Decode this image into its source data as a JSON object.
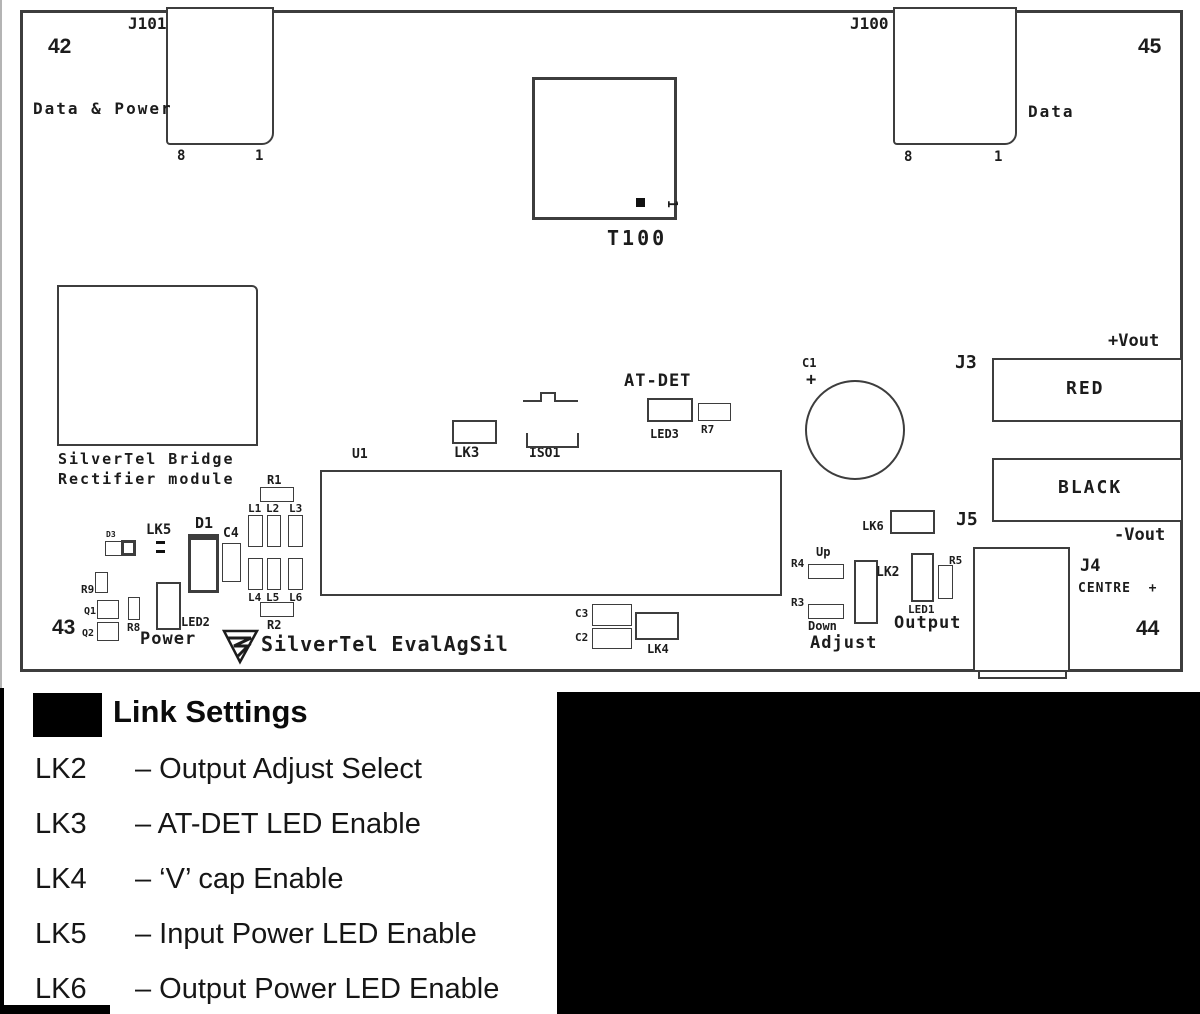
{
  "figure": {
    "name": "SilverTel EvalAgSil evaluation board layout",
    "board_title": "SilverTel EvalAgSil"
  },
  "colors": {
    "background": "#ffffff",
    "board_outline": "#222222",
    "component_outline": "#3d3d3d",
    "text": "#1c1c1c",
    "black_fill": "#000000"
  },
  "legend": {
    "title": "Link Settings",
    "rows": [
      {
        "code": "LK2",
        "desc": "– Output Adjust Select"
      },
      {
        "code": "LK3",
        "desc": "– AT-DET LED Enable"
      },
      {
        "code": "LK4",
        "desc": "– ‘V’ cap Enable"
      },
      {
        "code": "LK5",
        "desc": "– Input Power LED Enable"
      },
      {
        "code": "LK6",
        "desc": "– Output Power LED Enable"
      }
    ]
  },
  "board": {
    "rects": [
      {
        "n": "board-outline",
        "x": 20,
        "y": 10,
        "w": 1163,
        "h": 662,
        "bw": 3
      },
      {
        "n": "connector-j101",
        "x": 166,
        "y": 7,
        "w": 108,
        "h": 138,
        "bw": 2.5,
        "r": "0 0 12px 4px"
      },
      {
        "n": "connector-j100",
        "x": 893,
        "y": 7,
        "w": 124,
        "h": 138,
        "bw": 2.5,
        "r": "0 0 12px 4px"
      },
      {
        "n": "transformer-t100",
        "x": 532,
        "y": 77,
        "w": 145,
        "h": 143,
        "bw": 3
      },
      {
        "n": "t100-pin1-dot",
        "x": 636,
        "y": 198,
        "w": 9,
        "h": 9,
        "fill": true
      },
      {
        "n": "bridge-rectifier-module",
        "x": 57,
        "y": 285,
        "w": 201,
        "h": 161,
        "bw": 2,
        "r": "0 6px 0 0"
      },
      {
        "n": "ic-u1-box",
        "x": 320,
        "y": 470,
        "w": 462,
        "h": 126,
        "bw": 2
      },
      {
        "n": "link-lk3-box",
        "x": 452,
        "y": 420,
        "w": 45,
        "h": 24,
        "bw": 2
      },
      {
        "n": "led3-box",
        "x": 647,
        "y": 398,
        "w": 46,
        "h": 24,
        "bw": 2
      },
      {
        "n": "r7-box",
        "x": 698,
        "y": 403,
        "w": 33,
        "h": 18,
        "bw": 1.5
      },
      {
        "n": "terminal-red-box",
        "x": 992,
        "y": 358,
        "w": 191,
        "h": 64,
        "bw": 2.5
      },
      {
        "n": "terminal-black-box",
        "x": 992,
        "y": 458,
        "w": 191,
        "h": 64,
        "bw": 2.5
      },
      {
        "n": "link-lk6-box",
        "x": 890,
        "y": 510,
        "w": 45,
        "h": 24,
        "bw": 2
      },
      {
        "n": "d3-box-a",
        "x": 105,
        "y": 541,
        "w": 18,
        "h": 15,
        "bw": 1.5
      },
      {
        "n": "d3-box-b",
        "x": 121,
        "y": 540,
        "w": 15,
        "h": 16,
        "bw": 3
      },
      {
        "n": "lk5-dash-1",
        "x": 156,
        "y": 541,
        "w": 9,
        "h": 3,
        "fill": true
      },
      {
        "n": "lk5-dash-2",
        "x": 156,
        "y": 550,
        "w": 9,
        "h": 3,
        "fill": true
      },
      {
        "n": "diode-d1-box",
        "x": 188,
        "y": 534,
        "w": 31,
        "h": 59,
        "bw": 3,
        "bt": 6
      },
      {
        "n": "cap-c4-box",
        "x": 222,
        "y": 543,
        "w": 19,
        "h": 39,
        "bw": 1.5
      },
      {
        "n": "r1-box",
        "x": 260,
        "y": 487,
        "w": 34,
        "h": 15,
        "bw": 1.5
      },
      {
        "n": "l1-box",
        "x": 248,
        "y": 515,
        "w": 15,
        "h": 32,
        "bw": 1.5
      },
      {
        "n": "l2-box",
        "x": 267,
        "y": 515,
        "w": 14,
        "h": 32,
        "bw": 1.5
      },
      {
        "n": "l3-box",
        "x": 288,
        "y": 515,
        "w": 15,
        "h": 32,
        "bw": 1.5
      },
      {
        "n": "l4-box",
        "x": 248,
        "y": 558,
        "w": 15,
        "h": 32,
        "bw": 1.5
      },
      {
        "n": "l5-box",
        "x": 267,
        "y": 558,
        "w": 14,
        "h": 32,
        "bw": 1.5
      },
      {
        "n": "l6-box",
        "x": 288,
        "y": 558,
        "w": 15,
        "h": 32,
        "bw": 1.5
      },
      {
        "n": "r2-box",
        "x": 260,
        "y": 602,
        "w": 34,
        "h": 15,
        "bw": 1.5
      },
      {
        "n": "r9-box",
        "x": 95,
        "y": 572,
        "w": 13,
        "h": 21,
        "bw": 1.5
      },
      {
        "n": "q1-box",
        "x": 97,
        "y": 600,
        "w": 22,
        "h": 19,
        "bw": 1.5
      },
      {
        "n": "q2-box",
        "x": 97,
        "y": 622,
        "w": 22,
        "h": 19,
        "bw": 1.5
      },
      {
        "n": "r8-box",
        "x": 128,
        "y": 597,
        "w": 12,
        "h": 23,
        "bw": 1.5
      },
      {
        "n": "led2-box",
        "x": 156,
        "y": 582,
        "w": 25,
        "h": 48,
        "bw": 2
      },
      {
        "n": "cap-c3-box",
        "x": 592,
        "y": 604,
        "w": 40,
        "h": 22,
        "bw": 1.5
      },
      {
        "n": "cap-c2-box",
        "x": 592,
        "y": 628,
        "w": 40,
        "h": 21,
        "bw": 1.5
      },
      {
        "n": "link-lk4-box",
        "x": 635,
        "y": 612,
        "w": 44,
        "h": 28,
        "bw": 2
      },
      {
        "n": "r4-box",
        "x": 808,
        "y": 564,
        "w": 36,
        "h": 15,
        "bw": 1.5
      },
      {
        "n": "r3-box",
        "x": 808,
        "y": 604,
        "w": 36,
        "h": 15,
        "bw": 1.5
      },
      {
        "n": "link-lk2-box",
        "x": 854,
        "y": 560,
        "w": 24,
        "h": 64,
        "bw": 2
      },
      {
        "n": "led1-box",
        "x": 911,
        "y": 553,
        "w": 23,
        "h": 49,
        "bw": 2
      },
      {
        "n": "r5-box",
        "x": 938,
        "y": 565,
        "w": 15,
        "h": 34,
        "bw": 1.5
      },
      {
        "n": "connector-j4-box",
        "x": 973,
        "y": 547,
        "w": 97,
        "h": 125,
        "bw": 2.5
      },
      {
        "n": "connector-j4-ext",
        "x": 978,
        "y": 670,
        "w": 89,
        "h": 9,
        "bw": 2
      }
    ],
    "circles": [
      {
        "n": "cap-c1-circle",
        "cx": 855,
        "cy": 430,
        "r": 50,
        "bw": 2
      }
    ],
    "labels": [
      {
        "n": "label-j101",
        "t": "J101",
        "x": 128,
        "y": 16,
        "fs": 16
      },
      {
        "n": "label-42",
        "t": "42",
        "x": 48,
        "y": 36,
        "fs": 21,
        "f": "sans"
      },
      {
        "n": "label-data-power",
        "t": "Data & Power",
        "x": 33,
        "y": 101,
        "fs": 16,
        "ls": 2
      },
      {
        "n": "label-j101-pin8",
        "t": "8",
        "x": 177,
        "y": 149,
        "fs": 14
      },
      {
        "n": "label-j101-pin1",
        "t": "1",
        "x": 255,
        "y": 149,
        "fs": 14
      },
      {
        "n": "label-j100",
        "t": "J100",
        "x": 850,
        "y": 16,
        "fs": 16
      },
      {
        "n": "label-45",
        "t": "45",
        "x": 1138,
        "y": 36,
        "fs": 21,
        "f": "sans"
      },
      {
        "n": "label-data",
        "t": "Data",
        "x": 1028,
        "y": 104,
        "fs": 16,
        "ls": 2
      },
      {
        "n": "label-j100-pin8",
        "t": "8",
        "x": 904,
        "y": 150,
        "fs": 14
      },
      {
        "n": "label-j100-pin1",
        "t": "1",
        "x": 994,
        "y": 150,
        "fs": 14
      },
      {
        "n": "label-t100",
        "t": "T100",
        "x": 607,
        "y": 228,
        "fs": 20,
        "ls": 3
      },
      {
        "n": "label-t100-pin1",
        "t": "1",
        "x": 678,
        "y": 200,
        "fs": 13,
        "rot": 90
      },
      {
        "n": "label-bridge-line1",
        "t": "SilverTel Bridge",
        "x": 58,
        "y": 452,
        "fs": 15,
        "ls": 2
      },
      {
        "n": "label-bridge-line2",
        "t": "Rectifier module",
        "x": 58,
        "y": 472,
        "fs": 15,
        "ls": 2
      },
      {
        "n": "label-u1",
        "t": "U1",
        "x": 352,
        "y": 448,
        "fs": 13
      },
      {
        "n": "label-lk3",
        "t": "LK3",
        "x": 454,
        "y": 446,
        "fs": 14
      },
      {
        "n": "label-iso1",
        "t": "ISO1",
        "x": 529,
        "y": 447,
        "fs": 13
      },
      {
        "n": "label-at-det",
        "t": "AT-DET",
        "x": 624,
        "y": 373,
        "fs": 17,
        "ls": 1
      },
      {
        "n": "label-led3",
        "t": "LED3",
        "x": 650,
        "y": 428,
        "fs": 12
      },
      {
        "n": "label-r7",
        "t": "R7",
        "x": 701,
        "y": 424,
        "fs": 11
      },
      {
        "n": "label-c1",
        "t": "C1",
        "x": 802,
        "y": 357,
        "fs": 12
      },
      {
        "n": "label-c1-plus",
        "t": "+",
        "x": 806,
        "y": 372,
        "fs": 17
      },
      {
        "n": "label-j3",
        "t": "J3",
        "x": 955,
        "y": 354,
        "fs": 18
      },
      {
        "n": "label-plus-vout",
        "t": "+Vout",
        "x": 1108,
        "y": 333,
        "fs": 17
      },
      {
        "n": "label-red",
        "t": "RED",
        "x": 1066,
        "y": 380,
        "fs": 18,
        "ls": 2
      },
      {
        "n": "label-black",
        "t": "BLACK",
        "x": 1058,
        "y": 479,
        "fs": 18,
        "ls": 2
      },
      {
        "n": "label-j5",
        "t": "J5",
        "x": 956,
        "y": 511,
        "fs": 18
      },
      {
        "n": "label-minus-vout",
        "t": "-Vout",
        "x": 1114,
        "y": 527,
        "fs": 17
      },
      {
        "n": "label-lk6",
        "t": "LK6",
        "x": 862,
        "y": 520,
        "fs": 12
      },
      {
        "n": "label-d3",
        "t": "D3",
        "x": 106,
        "y": 531,
        "fs": 8
      },
      {
        "n": "label-lk5",
        "t": "LK5",
        "x": 146,
        "y": 523,
        "fs": 14
      },
      {
        "n": "label-d1",
        "t": "D1",
        "x": 195,
        "y": 516,
        "fs": 15
      },
      {
        "n": "label-c4",
        "t": "C4",
        "x": 223,
        "y": 527,
        "fs": 13
      },
      {
        "n": "label-r1",
        "t": "R1",
        "x": 267,
        "y": 474,
        "fs": 12
      },
      {
        "n": "label-l1",
        "t": "L1",
        "x": 248,
        "y": 503,
        "fs": 11
      },
      {
        "n": "label-l2",
        "t": "L2",
        "x": 266,
        "y": 503,
        "fs": 11
      },
      {
        "n": "label-l3",
        "t": "L3",
        "x": 289,
        "y": 503,
        "fs": 11
      },
      {
        "n": "label-l4",
        "t": "L4",
        "x": 248,
        "y": 592,
        "fs": 11
      },
      {
        "n": "label-l5",
        "t": "L5",
        "x": 266,
        "y": 592,
        "fs": 11
      },
      {
        "n": "label-l6",
        "t": "L6",
        "x": 289,
        "y": 592,
        "fs": 11
      },
      {
        "n": "label-r2",
        "t": "R2",
        "x": 267,
        "y": 619,
        "fs": 12
      },
      {
        "n": "label-r9",
        "t": "R9",
        "x": 81,
        "y": 584,
        "fs": 11
      },
      {
        "n": "label-q1",
        "t": "Q1",
        "x": 84,
        "y": 607,
        "fs": 10
      },
      {
        "n": "label-q2",
        "t": "Q2",
        "x": 82,
        "y": 629,
        "fs": 10
      },
      {
        "n": "label-r8",
        "t": "R8",
        "x": 127,
        "y": 622,
        "fs": 11
      },
      {
        "n": "label-led2",
        "t": "LED2",
        "x": 181,
        "y": 616,
        "fs": 12
      },
      {
        "n": "label-power",
        "t": "Power",
        "x": 140,
        "y": 631,
        "fs": 17,
        "ls": 1
      },
      {
        "n": "label-43",
        "t": "43",
        "x": 52,
        "y": 617,
        "fs": 21,
        "f": "sans"
      },
      {
        "n": "label-silvertel-evalagsil",
        "t": "SilverTel EvalAgSil",
        "x": 261,
        "y": 634,
        "fs": 20,
        "ls": 1
      },
      {
        "n": "label-c3",
        "t": "C3",
        "x": 575,
        "y": 608,
        "fs": 11
      },
      {
        "n": "label-c2",
        "t": "C2",
        "x": 575,
        "y": 632,
        "fs": 11
      },
      {
        "n": "label-lk4",
        "t": "LK4",
        "x": 647,
        "y": 643,
        "fs": 12
      },
      {
        "n": "label-up",
        "t": "Up",
        "x": 816,
        "y": 546,
        "fs": 12
      },
      {
        "n": "label-r4",
        "t": "R4",
        "x": 791,
        "y": 558,
        "fs": 11
      },
      {
        "n": "label-r3",
        "t": "R3",
        "x": 791,
        "y": 597,
        "fs": 11
      },
      {
        "n": "label-down",
        "t": "Down",
        "x": 808,
        "y": 620,
        "fs": 12
      },
      {
        "n": "label-adjust",
        "t": "Adjust",
        "x": 810,
        "y": 635,
        "fs": 17,
        "ls": 1
      },
      {
        "n": "label-lk2",
        "t": "LK2",
        "x": 876,
        "y": 566,
        "fs": 13
      },
      {
        "n": "label-led1",
        "t": "LED1",
        "x": 908,
        "y": 604,
        "fs": 11
      },
      {
        "n": "label-r5",
        "t": "R5",
        "x": 949,
        "y": 555,
        "fs": 11
      },
      {
        "n": "label-output",
        "t": "Output",
        "x": 894,
        "y": 615,
        "fs": 17,
        "ls": 1
      },
      {
        "n": "label-j4",
        "t": "J4",
        "x": 1080,
        "y": 558,
        "fs": 17
      },
      {
        "n": "label-centre-plus",
        "t": "CENTRE  +",
        "x": 1078,
        "y": 582,
        "fs": 13,
        "ls": 1
      },
      {
        "n": "label-44",
        "t": "44",
        "x": 1136,
        "y": 618,
        "fs": 21,
        "f": "sans"
      }
    ]
  }
}
